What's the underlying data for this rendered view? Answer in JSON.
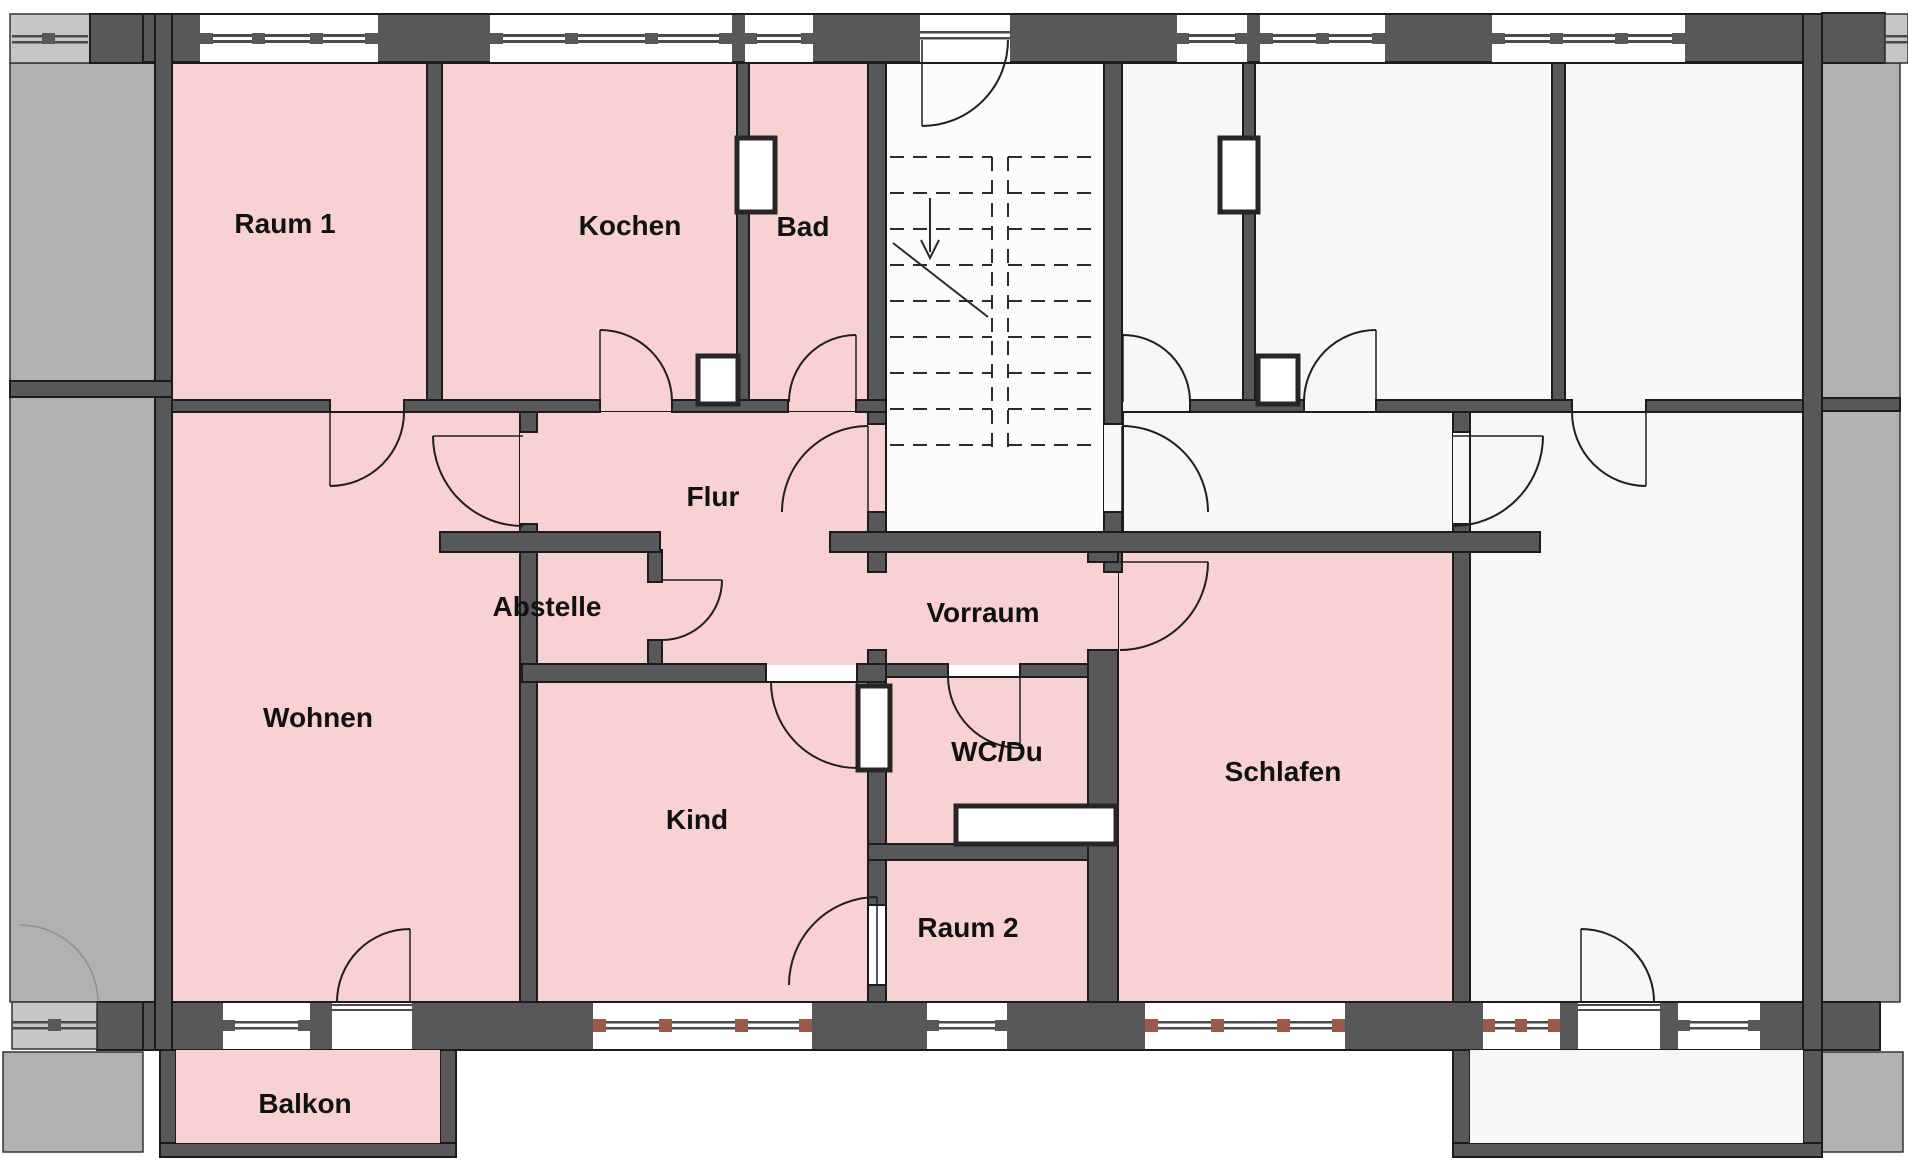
{
  "plan_title": "",
  "rooms": [
    {
      "id": "raum1",
      "label": "Raum 1"
    },
    {
      "id": "kochen",
      "label": "Kochen"
    },
    {
      "id": "bad",
      "label": "Bad"
    },
    {
      "id": "flur",
      "label": "Flur"
    },
    {
      "id": "abstelle",
      "label": "Abstelle"
    },
    {
      "id": "vorraum",
      "label": "Vorraum"
    },
    {
      "id": "wohnen",
      "label": "Wohnen"
    },
    {
      "id": "kind",
      "label": "Kind"
    },
    {
      "id": "wcdu",
      "label": "WC/Du"
    },
    {
      "id": "schlafen",
      "label": "Schlafen"
    },
    {
      "id": "raum2",
      "label": "Raum 2"
    },
    {
      "id": "balkon",
      "label": "Balkon"
    }
  ],
  "staircase": {
    "flights": 2,
    "direction_arrow": "down",
    "style": "dashed-above-cut"
  },
  "apartments": {
    "left": "highlighted-pink",
    "right": "unhighlighted-mirror"
  },
  "colors": {
    "room_highlight": "#f8d2d2",
    "wall": "#58585a",
    "neighbor_building": "#b1b1b1",
    "floor_light": "#f7f7f7",
    "window_sill_accent": "#9a5a49"
  }
}
